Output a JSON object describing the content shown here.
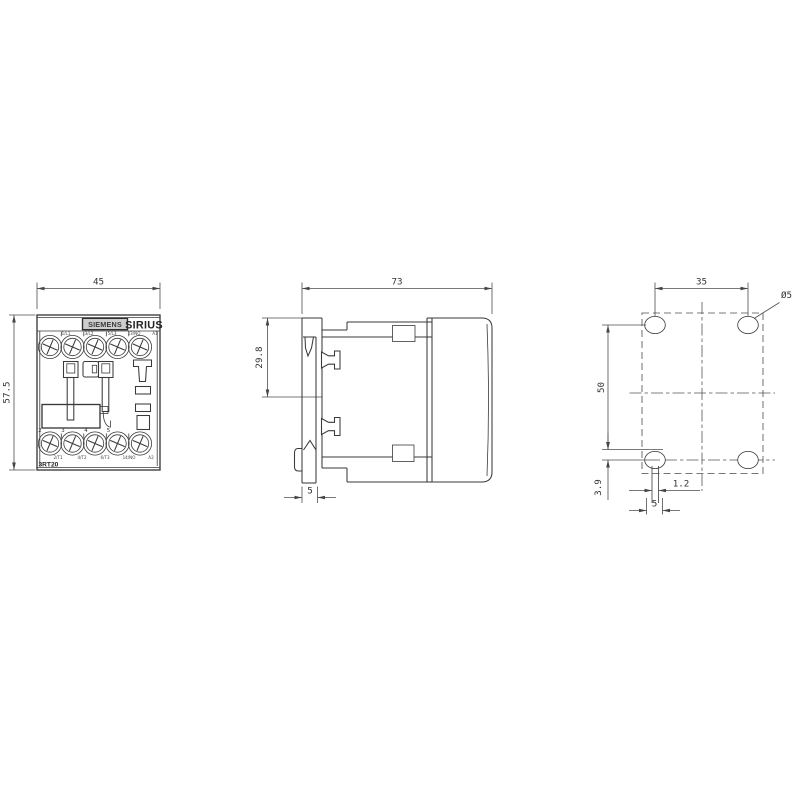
{
  "front": {
    "dim_width": "45",
    "dim_height": "57.5",
    "logo": "SIEMENS",
    "series": "SIRIUS",
    "model": "3RT20",
    "top_terminals": [
      "1/L1",
      "3/L2",
      "5/L3",
      "13/NO",
      "A1"
    ],
    "pole_numbers": [
      "2",
      "3",
      "4",
      "5"
    ],
    "bottom_terminals": [
      "2/T1",
      "4/T2",
      "6/T3",
      "14/NO",
      "A2"
    ]
  },
  "side": {
    "dim_depth": "73",
    "dim_clip_height": "29.8",
    "dim_foot": "5"
  },
  "drill": {
    "dim_pitch_h": "35",
    "dim_pitch_v": "50",
    "hole_dia": "Ø5",
    "slot_offset": "3.9",
    "slot_width": "1.2",
    "slot_length": "5"
  },
  "colors": {
    "line": "#3a3a3a",
    "dimension": "#4c4c4c",
    "text": "#333333",
    "logo_plate": "#cdcdcd",
    "background": "#ffffff"
  }
}
